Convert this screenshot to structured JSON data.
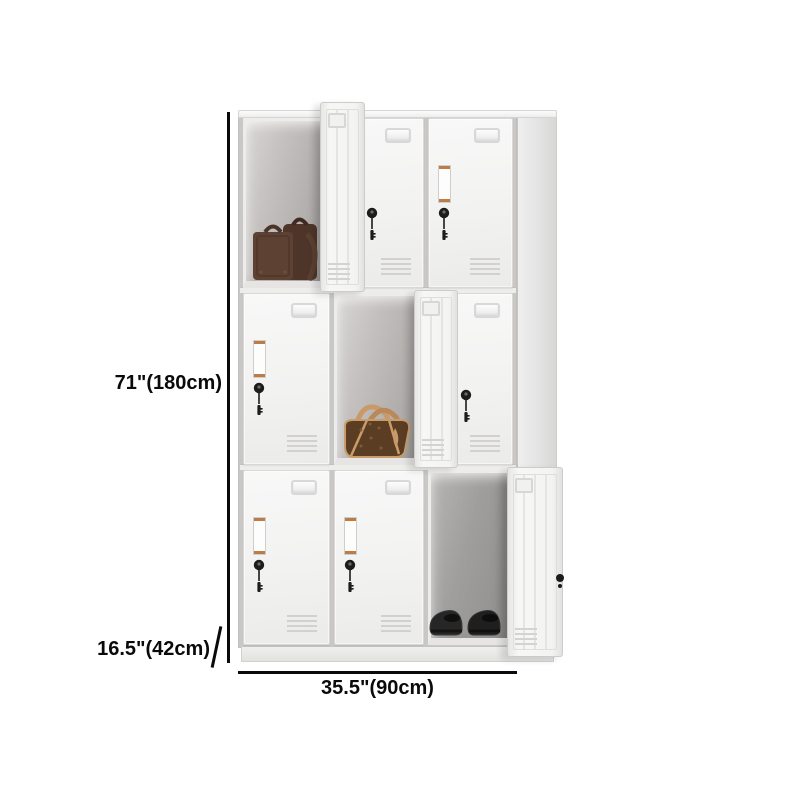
{
  "page": {
    "background": "#ffffff",
    "description": "Product dimension image of a white 9-door metal storage locker with three doors open"
  },
  "dimensions": {
    "height": "71\"(180cm)",
    "depth": "16.5\"(42cm)",
    "width": "35.5\"(90cm)"
  },
  "product": {
    "type": "9-door steel storage locker",
    "finish_color": "#f2f2f1",
    "grid": {
      "rows": 3,
      "columns": 3
    },
    "doors": [
      {
        "row": 1,
        "col": 1,
        "state": "open",
        "contents": "brown leather suitcase"
      },
      {
        "row": 1,
        "col": 2,
        "state": "closed",
        "contents": ""
      },
      {
        "row": 1,
        "col": 3,
        "state": "closed",
        "contents": ""
      },
      {
        "row": 2,
        "col": 1,
        "state": "closed",
        "contents": ""
      },
      {
        "row": 2,
        "col": 2,
        "state": "open",
        "contents": "brown monogram handbag"
      },
      {
        "row": 2,
        "col": 3,
        "state": "closed",
        "contents": ""
      },
      {
        "row": 3,
        "col": 1,
        "state": "closed",
        "contents": ""
      },
      {
        "row": 3,
        "col": 2,
        "state": "closed",
        "contents": ""
      },
      {
        "row": 3,
        "col": 3,
        "state": "open",
        "contents": "pair of black shoes"
      }
    ],
    "door_hardware": [
      "recessed-handle",
      "label-holder",
      "cam-lock-with-key",
      "vent-grille"
    ]
  },
  "annotation_style": {
    "line_color": "#0a0a0a",
    "text_color": "#0a0a0a"
  }
}
